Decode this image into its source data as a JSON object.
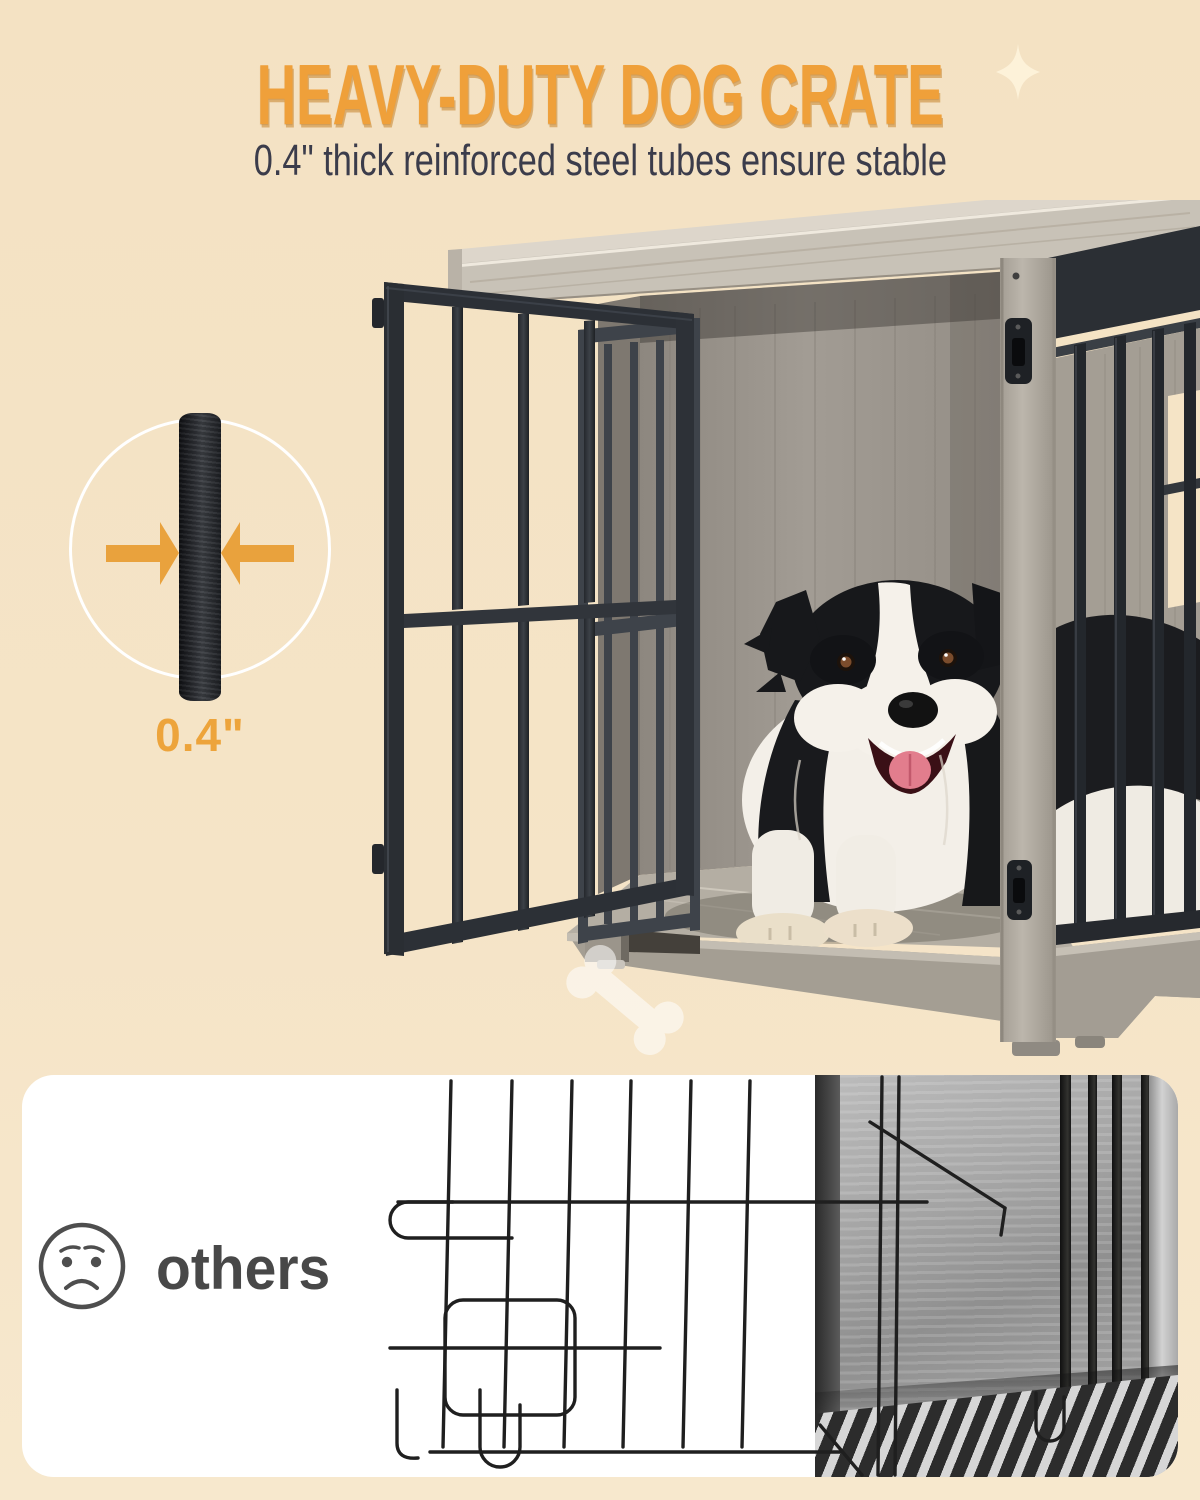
{
  "page": {
    "background_top": "#f4e2c3",
    "background_bottom": "#f7e8cd"
  },
  "header": {
    "title": "HEAVY-DUTY DOG CRATE",
    "subtitle": "0.4\" thick reinforced steel tubes ensure stable",
    "title_color": "#efa03a",
    "subtitle_color": "#3b3c4b"
  },
  "thickness_callout": {
    "value_label": "0.4\"",
    "icon": "steel-tube-sample",
    "arrow_color": "#e9a23d",
    "label_color": "#eda43b",
    "circle_outline_color": "#ffffff"
  },
  "hero": {
    "photo_alt": "Border Collie dog lying inside a grey wood dog crate with thick black steel bars and an open front door",
    "watermark_icon": "dog-bone",
    "sparkle_icon": "four-point-sparkle",
    "metal_color": "#2e3237",
    "wood_color": "#b6b0a5"
  },
  "comparison": {
    "label": "others",
    "label_color": "#484848",
    "mood_icon": "sad-face",
    "panel_background": "#ffffff",
    "photo_alt": "thin flimsy wire dog crate with bent wire door"
  }
}
